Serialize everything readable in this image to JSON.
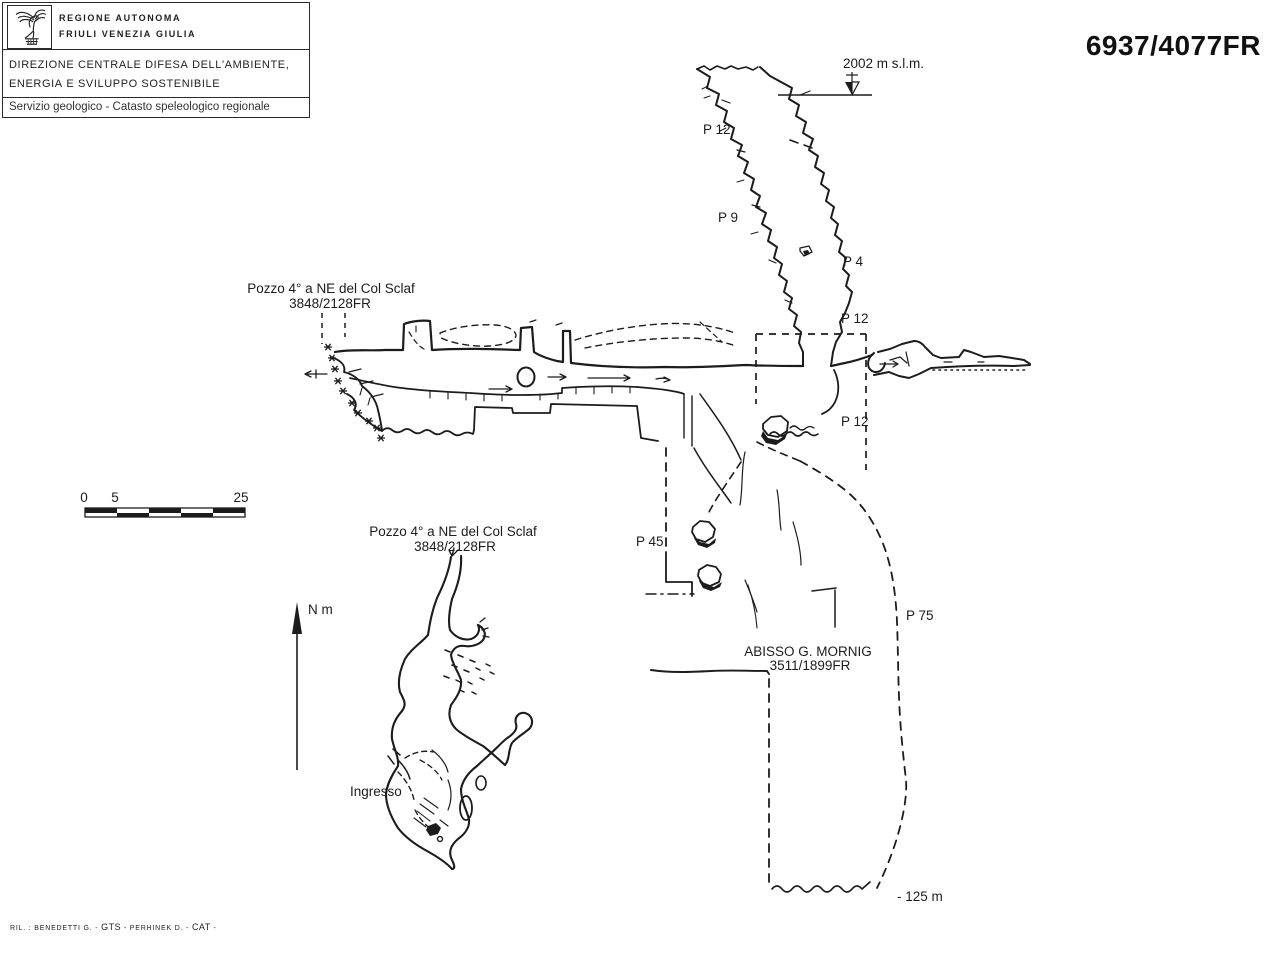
{
  "header": {
    "logo_icon": "fvg-eagle",
    "agency": {
      "line1": "Regione Autonoma",
      "line2": "Friuli Venezia Giulia"
    },
    "department": {
      "line1": "Direzione centrale difesa dell'ambiente,",
      "line2": "energia e sviluppo sostenibile"
    },
    "service": "Servizio geologico - Catasto speleologico regionale"
  },
  "cadastre_code": "6937/4077FR",
  "map": {
    "altitude_label": "2002 m s.l.m.",
    "north_label": "N m",
    "entrance_label": "Ingresso",
    "depth_label": "- 125 m",
    "scale_bar": {
      "tick0": "0",
      "tick1": "5",
      "tick2": "25"
    },
    "caves": [
      {
        "name": "Pozzo 4° a NE del Col Sclaf",
        "code": "3848/2128FR"
      },
      {
        "name": "Pozzo 4° a NE del Col Sclaf",
        "code": "3848/2128FR"
      },
      {
        "name": "ABISSO G. MORNIG",
        "code": "3511/1899FR"
      }
    ],
    "pitch_labels": [
      {
        "label": "P 12"
      },
      {
        "label": "P 9"
      },
      {
        "label": "P 4"
      },
      {
        "label": "P 12"
      },
      {
        "label": "P 12"
      },
      {
        "label": "P 45"
      },
      {
        "label": "P 75"
      }
    ]
  },
  "footer": {
    "credits_p1": "RIL. : BENEDETTI G. -",
    "credits_gts": "GTS",
    "credits_p2": "- PERHINEK D. -",
    "credits_cat": "CAT",
    "credits_p3": "-"
  },
  "colors": {
    "ink": "#1c1c1c",
    "paper": "#ffffff"
  }
}
